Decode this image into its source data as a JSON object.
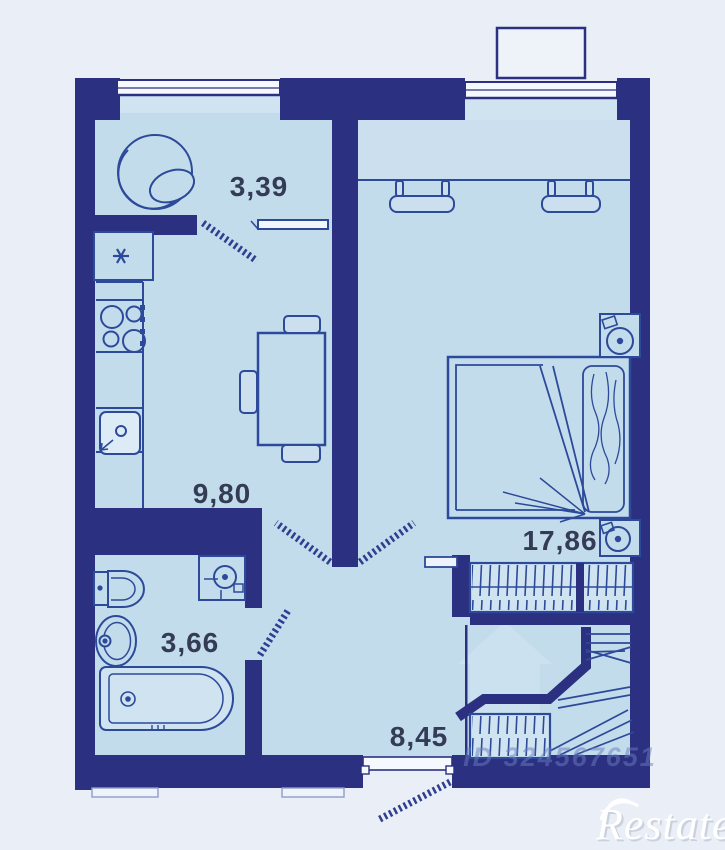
{
  "plan": {
    "title": "apartment-floor-plan",
    "rooms": [
      {
        "id": "balcony-room",
        "area": "3,39"
      },
      {
        "id": "kitchen",
        "area": "9,80"
      },
      {
        "id": "bedroom",
        "area": "17,86"
      },
      {
        "id": "bathroom",
        "area": "3,66"
      },
      {
        "id": "hallway",
        "area": "8,45"
      }
    ],
    "watermarks": {
      "listing_id": "ID 324567651",
      "brand": "Restate"
    },
    "colors": {
      "background": "#e9eef7",
      "wall": "#2b3180",
      "floor": "#c3dcec",
      "window_recess": "#cfe3f1",
      "furniture_line": "#2c4a99",
      "label_text": "#333b55",
      "window_white": "#f5f9fd"
    }
  }
}
